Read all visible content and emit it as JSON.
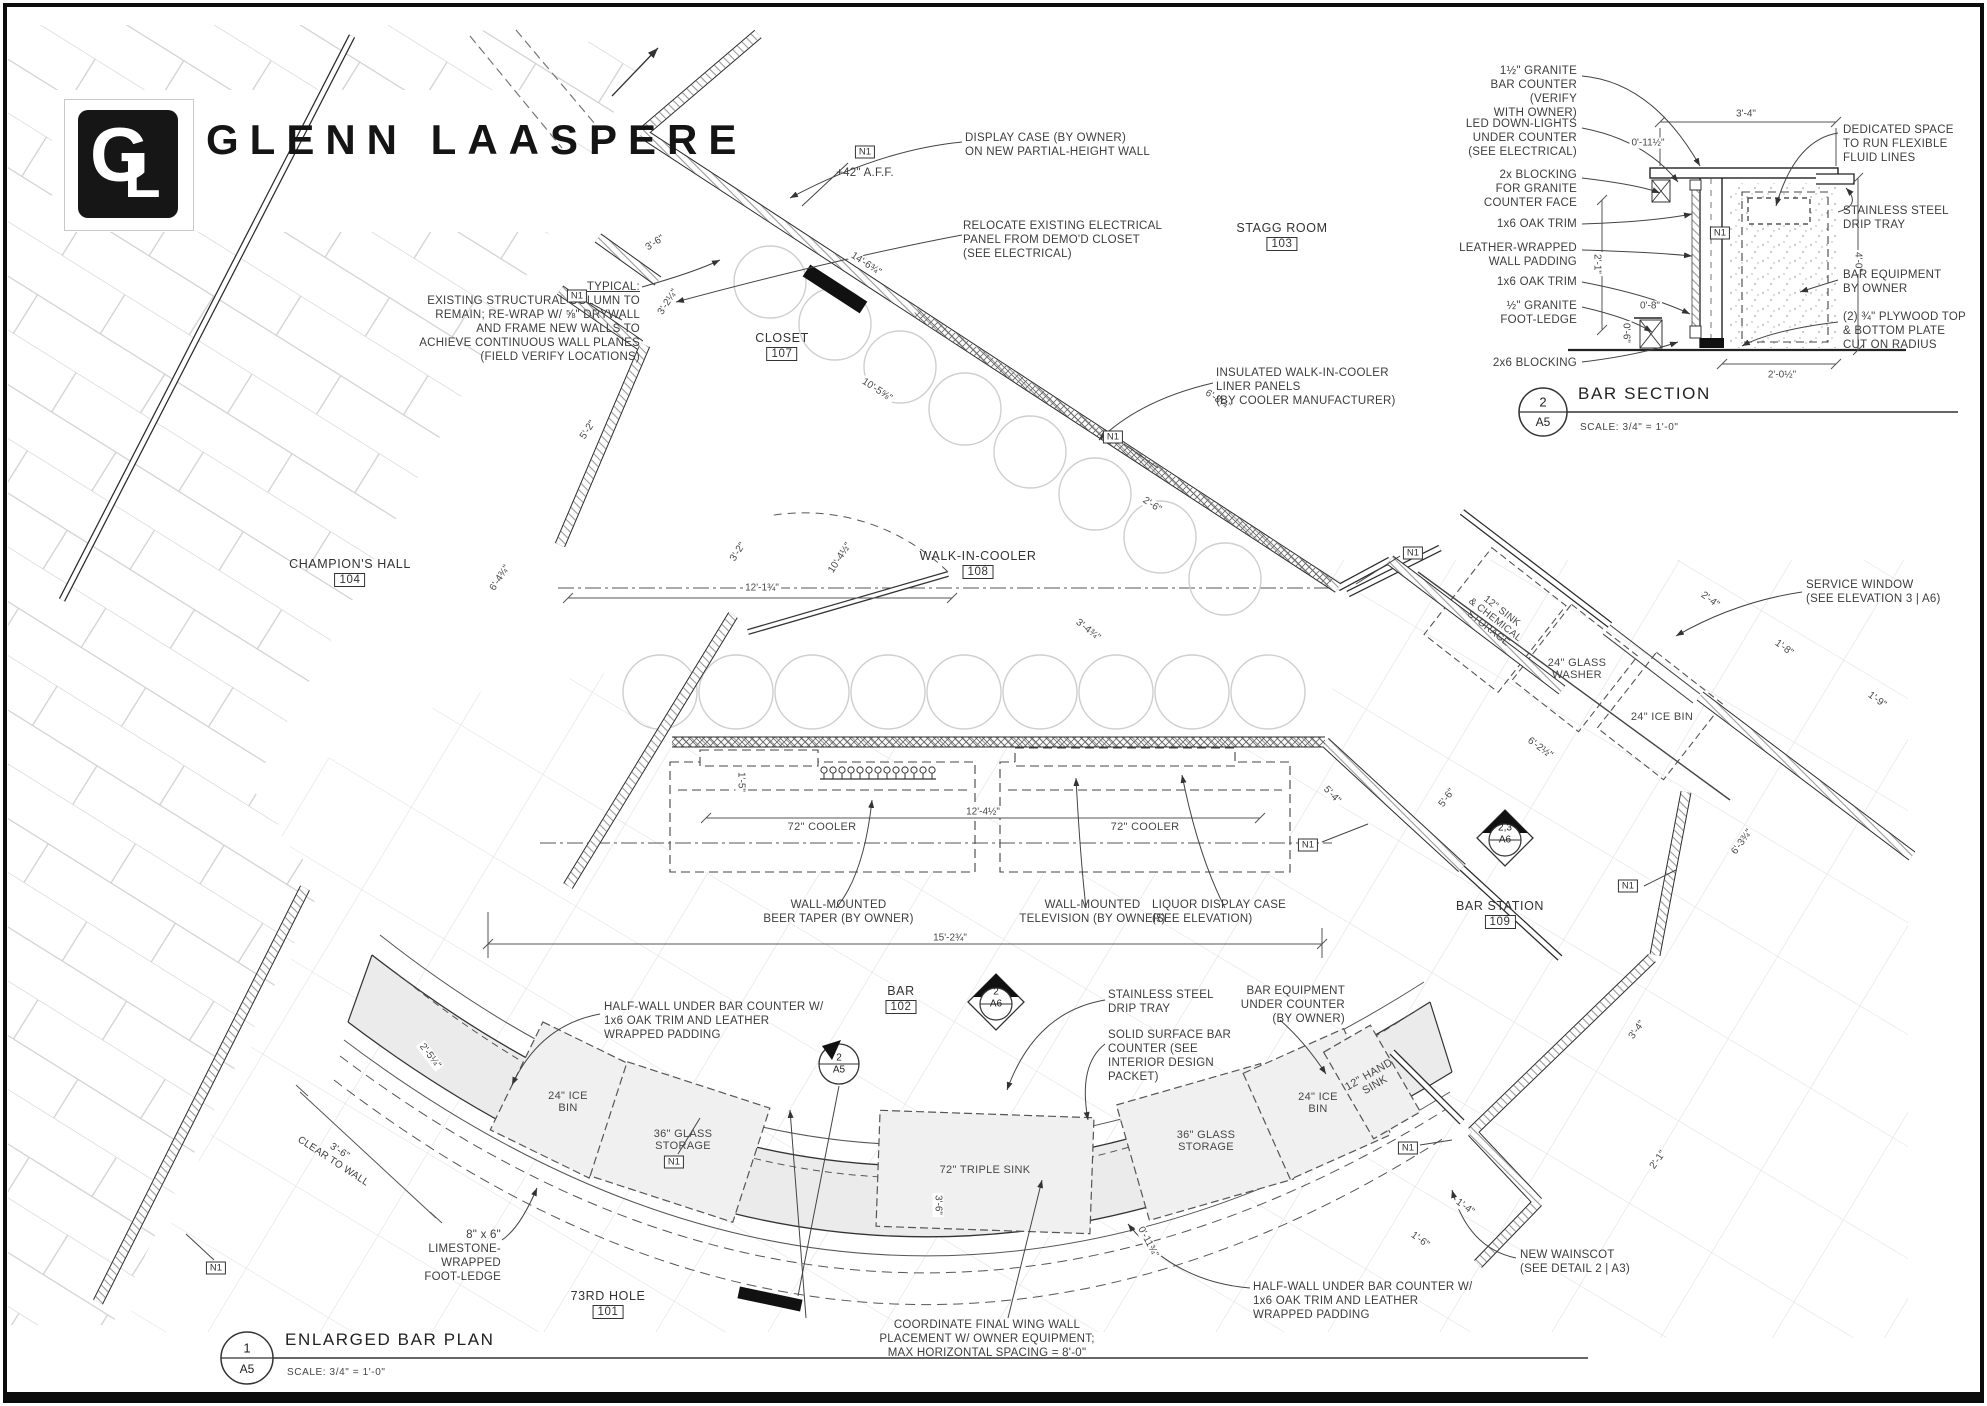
{
  "logo": {
    "g": "G",
    "l": "L",
    "name": "GLENN LAASPERE"
  },
  "rooms": {
    "stagg": {
      "name": "STAGG ROOM",
      "num": "103"
    },
    "champions": {
      "name": "CHAMPION'S HALL",
      "num": "104"
    },
    "cooler": {
      "name": "WALK-IN-COOLER",
      "num": "108"
    },
    "closet": {
      "name": "CLOSET",
      "num": "107"
    },
    "bar": {
      "name": "BAR",
      "num": "102"
    },
    "station": {
      "name": "BAR STATION",
      "num": "109"
    },
    "hole": {
      "name": "73RD HOLE",
      "num": "101"
    }
  },
  "notes": {
    "typical_head": "TYPICAL:",
    "typical_body": "EXISTING STRUCTURAL COLUMN TO\nREMAIN; RE-WRAP W/ ⅝\" DRYWALL\nAND FRAME NEW WALLS TO\nACHIEVE CONTINUOUS WALL PLANES\n(FIELD VERIFY LOCATIONS)",
    "display_case": "DISPLAY CASE (BY OWNER)\nON NEW PARTIAL-HEIGHT WALL",
    "relocate": "RELOCATE EXISTING ELECTRICAL\nPANEL FROM DEMO'D CLOSET\n(SEE ELECTRICAL)",
    "insulated": "INSULATED WALK-IN-COOLER\nLINER PANELS\n(BY COOLER MANUFACTURER)",
    "service_window": "SERVICE WINDOW\n(SEE ELEVATION 3 | A6)",
    "beer_taper": "WALL-MOUNTED\nBEER TAPER (BY OWNER)",
    "television": "WALL-MOUNTED\nTELEVISION (BY OWNER)",
    "liquor": "LIQUOR DISPLAY CASE\n(SEE ELEVATION)",
    "half_wall": "HALF-WALL UNDER BAR COUNTER W/\n1x6 OAK TRIM AND LEATHER\nWRAPPED PADDING",
    "drip_tray": "STAINLESS STEEL\nDRIP TRAY",
    "solid_surface": "SOLID SURFACE BAR\nCOUNTER (SEE\nINTERIOR DESIGN\nPACKET)",
    "bar_equip": "BAR EQUIPMENT\nUNDER COUNTER\n(BY OWNER)",
    "limestone": "8\" x 6\"\nLIMESTONE-WRAPPED\nFOOT-LEDGE",
    "coordinate": "COORDINATE FINAL WING WALL\nPLACEMENT W/ OWNER EQUIPMENT;\nMAX HORIZONTAL SPACING = 8'-0\"",
    "wainscot": "NEW WAINSCOT\n(SEE DETAIL 2 | A3)",
    "clear_wall": "3'-6\"\nCLEAR TO WALL",
    "aff": "+42\" A.F.F."
  },
  "equipment": {
    "cooler72": "72\" COOLER",
    "triple_sink": "72\" TRIPLE SINK",
    "ice24_2": "24\" ICE\nBIN",
    "ice24": "24\" ICE BIN",
    "glass36": "36\" GLASS\nSTORAGE",
    "washer24": "24\" GLASS\nWASHER",
    "sink12": "12\" SINK\n& CHEMICAL\nSTORAGE",
    "hand12": "12\" HAND\nSINK"
  },
  "markers": {
    "n1": "N1",
    "d2a6_n": "2",
    "d2a6_s": "A6",
    "d23a6_n": "2,3",
    "d23a6_s": "A6",
    "f2a5_n": "2",
    "f2a5_s": "A5"
  },
  "dims": [
    "3'-6\"",
    "14'-6¾\"",
    "3'-2¼\"",
    "10'-5⅝\"",
    "3'-2\"",
    "10'-4½\"",
    "12'-1¾\"",
    "5'-2\"",
    "6'-4¾\"",
    "12'-4½\"",
    "15'-2¾\"",
    "5'-4\"",
    "3'-4¾\"",
    "6'-8¼\"",
    "2'-6\"",
    "2'-4\"",
    "1'-8\"",
    "1'-9\"",
    "6'-2½\"",
    "5'-6\"",
    "6'-3¾\"",
    "3'-4\"",
    "2'-1\"",
    "1'-4\"",
    "1'-6\"",
    "2'-5¼\"",
    "0'-11¾\"",
    "3'-6\"",
    "1'-5\""
  ],
  "section": {
    "num": "2",
    "sheet": "A5",
    "title": "BAR SECTION",
    "scale": "SCALE: 3/4\" = 1'-0\"",
    "left": [
      "1½\" GRANITE\nBAR COUNTER (VERIFY\nWITH OWNER)",
      "LED DOWN-LIGHTS\nUNDER COUNTER\n(SEE ELECTRICAL)",
      "2x BLOCKING\nFOR GRANITE\nCOUNTER FACE",
      "1x6 OAK TRIM",
      "LEATHER-WRAPPED\nWALL PADDING",
      "1x6 OAK TRIM",
      "½\" GRANITE\nFOOT-LEDGE",
      "2x6 BLOCKING"
    ],
    "right": [
      "DEDICATED SPACE\nTO RUN FLEXIBLE\nFLUID LINES",
      "STAINLESS STEEL\nDRIP TRAY",
      "BAR EQUIPMENT\nBY OWNER",
      "(2) ¾\" PLYWOOD TOP\n& BOTTOM PLATE\nCUT ON RADIUS"
    ],
    "dims": [
      "3'-4\"",
      "0'-11½\"",
      "2'-1\"",
      "0'-8\"",
      "0'-6\"",
      "4'-0\"",
      "2'-0½\""
    ]
  },
  "titleblock": {
    "num": "1",
    "sheet": "A5",
    "title": "ENLARGED BAR PLAN",
    "scale": "SCALE: 3/4\" = 1'-0\""
  }
}
